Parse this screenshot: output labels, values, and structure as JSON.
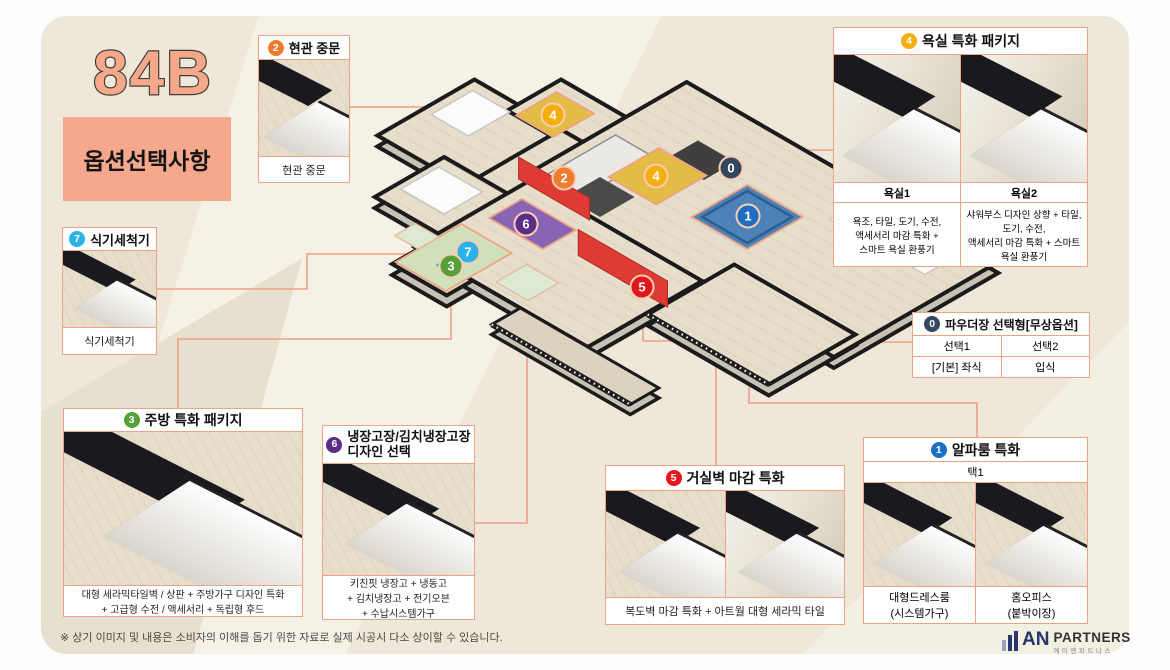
{
  "unit": {
    "code": "84B",
    "subtitle": "옵션선택사항"
  },
  "note": "※ 상기 이미지 및 내용은 소비자의 이해를 돕기 위한 자료로 실제 시공시 다소 상이할 수 있습니다.",
  "logo": {
    "an": "AN",
    "partners": "PARTNERS",
    "korean": "에이앤파트너스"
  },
  "colors": {
    "0": "#33475e",
    "1": "#1e6fc4",
    "2": "#ee7c2f",
    "3": "#55a038",
    "4": "#f5ae0c",
    "5": "#e2161d",
    "6": "#5c2d87",
    "7": "#29b2e8",
    "connector": "#efa182",
    "accent": "#f0a284",
    "panel": "#efe8da",
    "brand": "#f5a88c"
  },
  "callouts": {
    "door": {
      "num": "2",
      "title": "현관 중문",
      "caption": "현관 중문"
    },
    "bath": {
      "num": "4",
      "title": "욕실 특화 패키지",
      "cols": [
        {
          "label": "욕실1",
          "desc": "욕조, 타일, 도기, 수전,\n액세서리 마감 특화 +\n스마트 욕실 환풍기"
        },
        {
          "label": "욕실2",
          "desc": "샤워부스 디자인 상향 + 타일,\n도기, 수전,\n액세서리 마감 특화 + 스마트\n욕실 환풍기"
        }
      ]
    },
    "powder": {
      "num": "0",
      "title": "파우더장 선택형[무상옵션]",
      "headers": [
        "선택1",
        "선택2"
      ],
      "values": [
        "[기본] 좌식",
        "입식"
      ]
    },
    "dishwasher": {
      "num": "7",
      "title": "식기세척기",
      "caption": "식기세척기"
    },
    "kitchen": {
      "num": "3",
      "title": "주방 특화 패키지",
      "caption": "대형 세라믹타일벽 / 상판 + 주방가구 디자인 특화\n+ 고급형 수전 / 액세서리 + 독립형 후드"
    },
    "fridge": {
      "num": "6",
      "title": "냉장고장/김치냉장고장\n디자인 선택",
      "caption": "키친핏 냉장고 + 냉동고\n+ 김치냉장고 + 전기오븐\n+ 수납시스템가구"
    },
    "livingwall": {
      "num": "5",
      "title": "거실벽 마감 특화",
      "caption": "복도벽 마감 특화 + 아트월 대형 세라믹 타일"
    },
    "alpha": {
      "num": "1",
      "title": "알파룸 특화",
      "subtitle": "택1",
      "cols": [
        {
          "caption": "대형드레스룸\n(시스템가구)"
        },
        {
          "caption": "홈오피스\n(붙박이장)"
        }
      ]
    }
  },
  "plan_badges": [
    {
      "n": "4",
      "x": 553,
      "y": 115
    },
    {
      "n": "2",
      "x": 564,
      "y": 178
    },
    {
      "n": "4",
      "x": 656,
      "y": 176
    },
    {
      "n": "0",
      "x": 731,
      "y": 168
    },
    {
      "n": "1",
      "x": 748,
      "y": 216
    },
    {
      "n": "6",
      "x": 526,
      "y": 224
    },
    {
      "n": "7",
      "x": 468,
      "y": 252
    },
    {
      "n": "3",
      "x": 451,
      "y": 266
    },
    {
      "n": "5",
      "x": 642,
      "y": 287
    }
  ]
}
